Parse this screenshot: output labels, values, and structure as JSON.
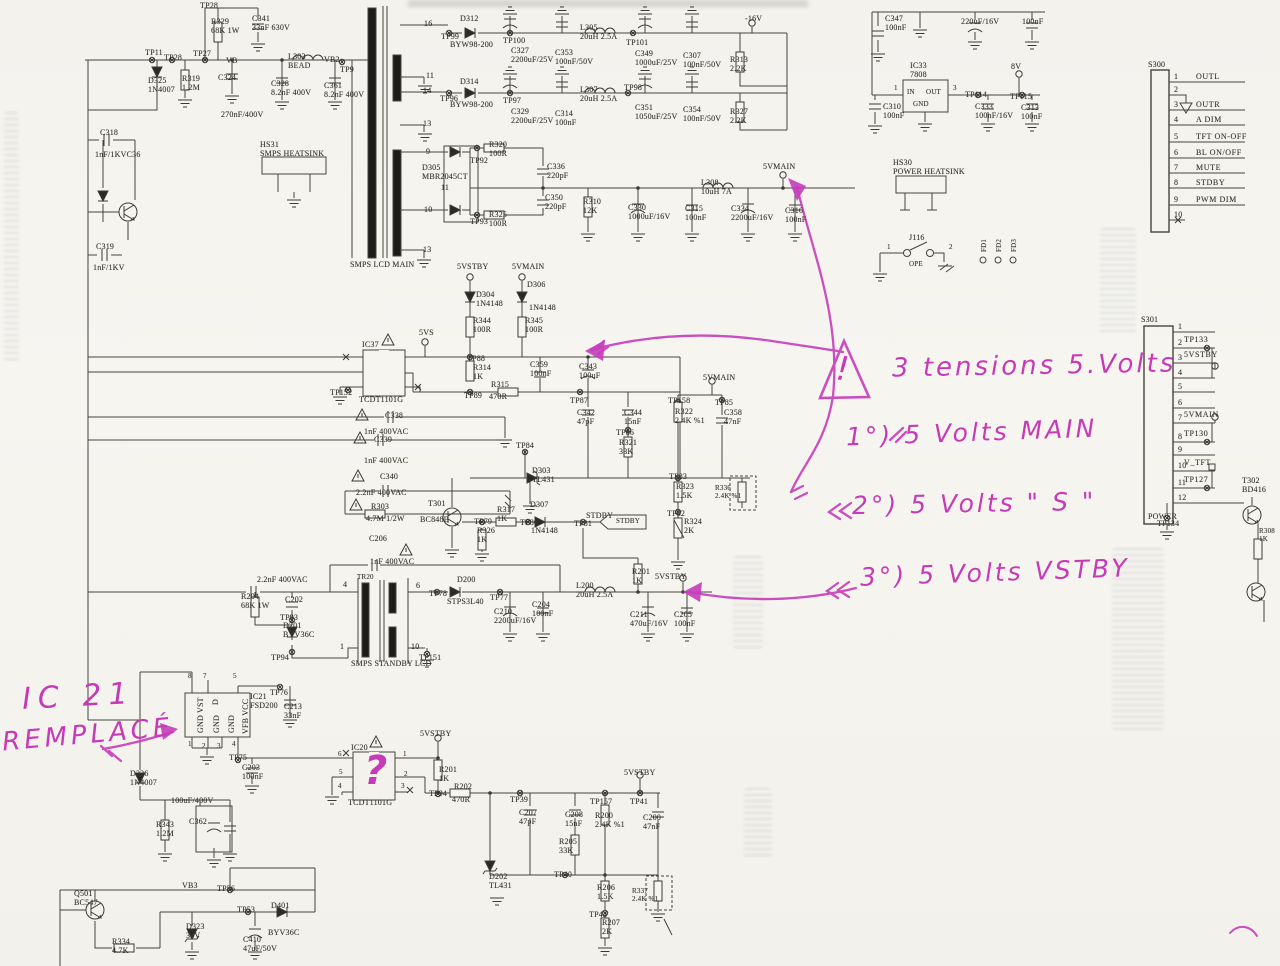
{
  "colors": {
    "paper": "#f5f3ee",
    "ink": "#3c3a36",
    "annotation": "#c63ab8"
  },
  "connectors": {
    "s300": {
      "id": "S300",
      "pins": [
        {
          "n": "1",
          "label": "OUTL"
        },
        {
          "n": "2",
          "label": ""
        },
        {
          "n": "3",
          "label": "OUTR"
        },
        {
          "n": "4",
          "label": "A DIM"
        },
        {
          "n": "5",
          "label": "TFT ON-OFF"
        },
        {
          "n": "6",
          "label": "BL ON/OFF"
        },
        {
          "n": "7",
          "label": "MUTE"
        },
        {
          "n": "8",
          "label": "STDBY"
        },
        {
          "n": "9",
          "label": "PWM DIM"
        },
        {
          "n": "10",
          "label": ""
        }
      ]
    },
    "s301": {
      "id": "S301",
      "name": "POWER",
      "pins": [
        {
          "n": "1",
          "label": ""
        },
        {
          "n": "2",
          "label": "TP133"
        },
        {
          "n": "3",
          "label": "5VSTBY"
        },
        {
          "n": "4",
          "label": ""
        },
        {
          "n": "5",
          "label": ""
        },
        {
          "n": "6",
          "label": ""
        },
        {
          "n": "7",
          "label": "5VMAIN"
        },
        {
          "n": "8",
          "label": "TP130"
        },
        {
          "n": "9",
          "label": ""
        },
        {
          "n": "10",
          "label": "V_TFT"
        },
        {
          "n": "11",
          "label": "TP127"
        },
        {
          "n": "12",
          "label": ""
        }
      ]
    }
  },
  "annotations": {
    "heading": "3 tensions 5.Volts",
    "item1": "1°) 5 Volts MAIN",
    "item2": "2°) 5 Volts \" S \"",
    "item3": "3°) 5 Volts VSTBY",
    "ic21_ref": "IC 21",
    "ic21_note": "REMPLACÉ",
    "question_mark": "?",
    "exclamation": "!"
  },
  "labels": [
    [
      "TP28",
      200,
      1
    ],
    [
      "TP11",
      145,
      48
    ],
    [
      "TP28",
      164,
      53
    ],
    [
      "TP27",
      193,
      49
    ],
    [
      "VB",
      226,
      56
    ],
    [
      "R329\n68K 1W",
      211,
      17
    ],
    [
      "C341\n33nF 630V",
      252,
      14
    ],
    [
      "D325\n1N4007",
      148,
      76
    ],
    [
      "R319\n1.2M",
      182,
      74
    ],
    [
      "C324",
      218,
      73
    ],
    [
      "270nF/400V",
      221,
      110
    ],
    [
      "C328\n8.2nF 400V",
      271,
      79
    ],
    [
      "L303\nBEAD",
      288,
      52
    ],
    [
      "VB2",
      324,
      55
    ],
    [
      "TP9",
      340,
      65
    ],
    [
      "C361\n8.2nF 400V",
      324,
      81
    ],
    [
      "C318",
      100,
      128
    ],
    [
      "1nF/1KVC36",
      95,
      150
    ],
    [
      "C319",
      96,
      242
    ],
    [
      "1nF/1KV",
      93,
      263
    ],
    [
      "HS31\nSMPS HEATSINK",
      260,
      140
    ],
    [
      "SMPS LCD MAIN",
      350,
      260
    ],
    [
      "16",
      424,
      19
    ],
    [
      "D312",
      460,
      14
    ],
    [
      "TP99",
      441,
      32
    ],
    [
      "BYW98-200",
      450,
      40
    ],
    [
      "TP100",
      503,
      36
    ],
    [
      "C327\n2200uF/25V",
      511,
      46
    ],
    [
      "C353\n100nF/50V",
      555,
      48
    ],
    [
      "L305\n20uH 2.5A",
      580,
      23
    ],
    [
      "TP101",
      626,
      38
    ],
    [
      "C349\n1000uF/25V",
      635,
      49
    ],
    [
      "C307\n100nF/50V",
      683,
      51
    ],
    [
      "R313\n2.2K",
      730,
      55
    ],
    [
      "-16V",
      745,
      14
    ],
    [
      "11",
      426,
      71
    ],
    [
      "14",
      423,
      86
    ],
    [
      "D314",
      460,
      77
    ],
    [
      "TP96",
      440,
      94
    ],
    [
      "BYW98-200",
      450,
      100
    ],
    [
      "TP97",
      503,
      96
    ],
    [
      "C329\n2200uF/25V",
      511,
      107
    ],
    [
      "C314\n100nF",
      555,
      109
    ],
    [
      "L307\n20uH 2.5A",
      580,
      85
    ],
    [
      "TP98",
      624,
      83
    ],
    [
      "C351\n1050uF/25V",
      635,
      103
    ],
    [
      "C354\n100nF/50V",
      683,
      105
    ],
    [
      "R327\n2.2K",
      730,
      107
    ],
    [
      "13",
      423,
      119
    ],
    [
      "9",
      426,
      147
    ],
    [
      "D305\nMBR2045CT",
      422,
      163
    ],
    [
      "R320\n100R",
      489,
      140
    ],
    [
      "TP92",
      470,
      156
    ],
    [
      "C336\n220pF",
      547,
      162
    ],
    [
      "11",
      441,
      183
    ],
    [
      "C350\n220pF",
      545,
      193
    ],
    [
      "10",
      424,
      205
    ],
    [
      "R325\n100R",
      489,
      210
    ],
    [
      "TP93",
      470,
      217
    ],
    [
      "R310\n12K",
      583,
      197
    ],
    [
      "C330\n1000uF/16V",
      628,
      203
    ],
    [
      "C315\n100nF",
      685,
      204
    ],
    [
      "L308\n10uH 7A",
      701,
      178
    ],
    [
      "C334\n2200uF/16V",
      731,
      204
    ],
    [
      "C316\n100nF",
      785,
      206
    ],
    [
      "5VMAIN",
      763,
      162
    ],
    [
      "13",
      423,
      245
    ],
    [
      "5VSTBY",
      457,
      262
    ],
    [
      "5VMAIN",
      512,
      262
    ],
    [
      "D304\n1N4148",
      476,
      290
    ],
    [
      "D306",
      527,
      280
    ],
    [
      "1N4148",
      529,
      303
    ],
    [
      "R344\n100R",
      473,
      316
    ],
    [
      "R345\n100R",
      525,
      316
    ],
    [
      "5VS",
      419,
      328
    ],
    [
      "IC37",
      362,
      340
    ],
    [
      "TCDT1101G",
      359,
      395
    ],
    [
      "TP152",
      330,
      388
    ],
    [
      "TP88",
      467,
      354
    ],
    [
      "R314\n1K",
      473,
      363
    ],
    [
      "TP89",
      464,
      391
    ],
    [
      "R315",
      491,
      380
    ],
    [
      "470R",
      489,
      392
    ],
    [
      "C359\n100nF",
      530,
      360
    ],
    [
      "C343\n100uF",
      579,
      362
    ],
    [
      "TP87",
      570,
      396
    ],
    [
      "C342\n47pF",
      577,
      408
    ],
    [
      "C344\n15nF",
      624,
      408
    ],
    [
      "TP86",
      616,
      428
    ],
    [
      "R321\n33K",
      619,
      438
    ],
    [
      "TP84",
      516,
      441
    ],
    [
      "C338",
      385,
      411
    ],
    [
      "1nF 400VAC",
      364,
      427
    ],
    [
      "C339",
      374,
      435
    ],
    [
      "1nF 400VAC",
      364,
      456
    ],
    [
      "C340",
      380,
      472
    ],
    [
      "2.2nF 400VAC",
      356,
      488
    ],
    [
      "R303",
      371,
      502
    ],
    [
      "4.7M 1/2W",
      366,
      514
    ],
    [
      "C206",
      369,
      534
    ],
    [
      "1nF 400VAC",
      370,
      557
    ],
    [
      "D303\nTL431",
      532,
      466
    ],
    [
      "T301",
      428,
      499
    ],
    [
      "BC848B",
      420,
      515
    ],
    [
      "TP79",
      474,
      517
    ],
    [
      "R317\n1K",
      497,
      505
    ],
    [
      "TP80",
      520,
      518
    ],
    [
      "D307",
      530,
      500
    ],
    [
      "1N4148",
      531,
      526
    ],
    [
      "TP81",
      574,
      519
    ],
    [
      "STDBY",
      586,
      511
    ],
    [
      "STDBY",
      616,
      517,
      "7"
    ],
    [
      "R326\n1K",
      477,
      526
    ],
    [
      "5VMAIN",
      703,
      373
    ],
    [
      "TP158",
      668,
      396
    ],
    [
      "R322\n2.4K %1",
      675,
      407
    ],
    [
      "TP85",
      715,
      398
    ],
    [
      "C358\n47nF",
      724,
      408
    ],
    [
      "TP83",
      669,
      472
    ],
    [
      "R323\n1.5K",
      676,
      482
    ],
    [
      "R336\n2.4K %1",
      715,
      484,
      "7"
    ],
    [
      "TP82",
      667,
      509
    ],
    [
      "R324\n2K",
      684,
      517
    ],
    [
      "TR20",
      357,
      573,
      "7"
    ],
    [
      "4",
      343,
      580
    ],
    [
      "6",
      416,
      581
    ],
    [
      "1",
      340,
      642
    ],
    [
      "10",
      411,
      642
    ],
    [
      "TP78",
      429,
      589
    ],
    [
      "D200",
      457,
      575
    ],
    [
      "STPS3L40",
      447,
      597
    ],
    [
      "TP77",
      490,
      593
    ],
    [
      "C210\n2200uF/16V",
      494,
      607
    ],
    [
      "C204\n100nF",
      532,
      600
    ],
    [
      "L200\n20uH 2.5A",
      576,
      581
    ],
    [
      "R201\n1K",
      632,
      567
    ],
    [
      "C211\n470uF/16V",
      630,
      610
    ],
    [
      "C205\n100nF",
      674,
      610
    ],
    [
      "5VSTBY",
      655,
      572
    ],
    [
      "TP151",
      419,
      653
    ],
    [
      "SMPS STANDBY LCD",
      351,
      659
    ],
    [
      "2.2nF 400VAC",
      257,
      575
    ],
    [
      "R204\n68K 1W",
      241,
      592
    ],
    [
      "C202",
      285,
      595
    ],
    [
      "TP93",
      280,
      613
    ],
    [
      "D201\nBYV36C",
      283,
      621
    ],
    [
      "TP94",
      271,
      653
    ],
    [
      "8",
      188,
      672,
      "7"
    ],
    [
      "7",
      203,
      672,
      "7"
    ],
    [
      "5",
      233,
      672,
      "7"
    ],
    [
      "IC21\nFSD200",
      250,
      692
    ],
    [
      "TP76",
      270,
      688
    ],
    [
      "C213\n33nF",
      284,
      702
    ],
    [
      "1",
      188,
      740,
      "7"
    ],
    [
      "2",
      202,
      742,
      "7"
    ],
    [
      "3",
      217,
      742,
      "7"
    ],
    [
      "4",
      232,
      740,
      "7"
    ],
    [
      "TP75",
      229,
      753
    ],
    [
      "C203\n100nF",
      242,
      763
    ],
    [
      "D326\n1N4007",
      130,
      769
    ],
    [
      "GND VST",
      196,
      733,
      "r"
    ],
    [
      "D",
      211,
      705,
      "r"
    ],
    [
      "GND",
      212,
      733,
      "r"
    ],
    [
      "GND",
      227,
      733,
      "r"
    ],
    [
      "VFB VCC",
      241,
      734,
      "r"
    ],
    [
      "IC20",
      351,
      743
    ],
    [
      "TCDT1101G",
      348,
      798
    ],
    [
      "6",
      338,
      750,
      "7"
    ],
    [
      "5",
      339,
      768,
      "7"
    ],
    [
      "4",
      338,
      782,
      "7"
    ],
    [
      "1",
      403,
      750,
      "7"
    ],
    [
      "2",
      404,
      770,
      "7"
    ],
    [
      "3",
      401,
      782,
      "7"
    ],
    [
      "5VSTBY",
      420,
      729
    ],
    [
      "R201\n1K",
      439,
      765
    ],
    [
      "TP94",
      429,
      789
    ],
    [
      "R202",
      454,
      782
    ],
    [
      "470R",
      452,
      795
    ],
    [
      "TP39",
      510,
      795
    ],
    [
      "C207\n47pF",
      519,
      808
    ],
    [
      "C208\n15nF",
      565,
      810
    ],
    [
      "R205\n33K",
      559,
      837
    ],
    [
      "D202\nTL431",
      489,
      872
    ],
    [
      "TP40",
      554,
      870
    ],
    [
      "TP157",
      590,
      797
    ],
    [
      "R200\n2.4K %1",
      595,
      811
    ],
    [
      "TP41",
      630,
      797
    ],
    [
      "C200\n47nF",
      643,
      813
    ],
    [
      "5VSTBY",
      624,
      768
    ],
    [
      "R206\n1.5K",
      597,
      883
    ],
    [
      "TP42",
      589,
      910
    ],
    [
      "R207\n2K",
      602,
      918
    ],
    [
      "R337\n2.4K %1",
      632,
      887,
      "7"
    ],
    [
      "100uF/400V",
      171,
      796
    ],
    [
      "R343\n1.2M",
      156,
      820
    ],
    [
      "C362",
      189,
      817
    ],
    [
      "Q501\nBC547",
      74,
      889
    ],
    [
      "VB3",
      182,
      881
    ],
    [
      "TP56",
      217,
      884
    ],
    [
      "R334\n4.7K",
      112,
      937
    ],
    [
      "D323\n33V",
      186,
      922
    ],
    [
      "TP53",
      237,
      905
    ],
    [
      "D401",
      271,
      901
    ],
    [
      "BYV36C",
      268,
      928
    ],
    [
      "C410\n47uF/50V",
      243,
      935
    ],
    [
      "C347\n100nF",
      885,
      14
    ],
    [
      "220uF/16V",
      961,
      17
    ],
    [
      "100nF",
      1022,
      17
    ],
    [
      "IC33\n7808",
      910,
      61
    ],
    [
      "IN",
      907,
      88,
      "7"
    ],
    [
      "OUT",
      926,
      88,
      "7"
    ],
    [
      "GND",
      913,
      100,
      "7"
    ],
    [
      "1",
      894,
      84,
      "7"
    ],
    [
      "3",
      953,
      84,
      "7"
    ],
    [
      "8V",
      1011,
      62
    ],
    [
      "TP114",
      965,
      90
    ],
    [
      "C333\n100nF/16V",
      975,
      102
    ],
    [
      "TP115",
      1010,
      92
    ],
    [
      "C313\n100nF",
      1021,
      103
    ],
    [
      "C310\n100nF",
      883,
      102
    ],
    [
      "HS30\nPOWER HEATSINK",
      893,
      158
    ],
    [
      "J116",
      909,
      233
    ],
    [
      "1",
      887,
      243,
      "7"
    ],
    [
      "2",
      949,
      243,
      "7"
    ],
    [
      "OPE",
      909,
      260,
      "7"
    ],
    [
      "FD1",
      980,
      252,
      "r7"
    ],
    [
      "FD2",
      995,
      252,
      "r7"
    ],
    [
      "FD3",
      1010,
      252,
      "r7"
    ],
    [
      "TP134",
      1157,
      519
    ],
    [
      "T302\nBD416",
      1242,
      476
    ],
    [
      "R308\n1K",
      1259,
      527,
      "7"
    ]
  ]
}
